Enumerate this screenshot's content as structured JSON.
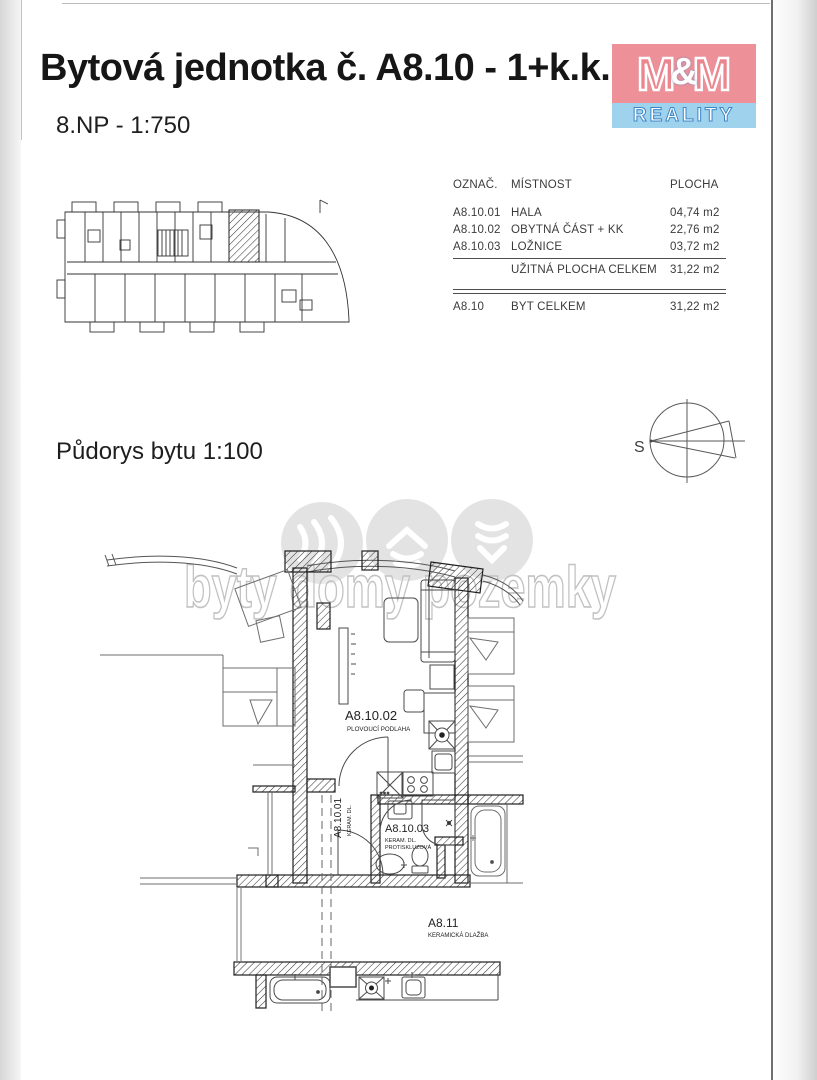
{
  "page": {
    "title": "Bytová jednotka č. A8.10 - 1+k.k.",
    "floor_label": "8.NP - 1:750",
    "plan_label": "Půdorys bytu 1:100"
  },
  "logo": {
    "m_left": "M",
    "ampersand": "&",
    "m_right": "M",
    "reality": "REALITY",
    "pink": "#ee9097",
    "blue": "#9fd2ec"
  },
  "table": {
    "headers": [
      "OZNAČ.",
      "MÍSTNOST",
      "PLOCHA"
    ],
    "rows": [
      {
        "code": "A8.10.01",
        "room": "HALA",
        "area": "04,74 m2"
      },
      {
        "code": "A8.10.02",
        "room": "OBYTNÁ ČÁST + KK",
        "area": "22,76 m2"
      },
      {
        "code": "A8.10.03",
        "room": "LOŽNICE",
        "area": "03,72 m2"
      }
    ],
    "subtotal": {
      "code": "",
      "room": "UŽITNÁ PLOCHA CELKEM",
      "area": "31,22 m2"
    },
    "total": {
      "code": "A8.10",
      "room": "BYT CELKEM",
      "area": "31,22 m2"
    }
  },
  "compass": {
    "north_label": "S"
  },
  "watermark": {
    "text": "byty domy pozemky"
  },
  "plan": {
    "living": {
      "code": "A8.10.02",
      "floor": "PLOVOUCÍ PODLAHA"
    },
    "hall": {
      "code": "A8.10.01",
      "floor": "KERAM. DL."
    },
    "bath": {
      "code": "A8.10.03",
      "floor_line1": "KERAM. DL.",
      "floor_line2": "PROTISKLUZOVÁ"
    },
    "corridor": {
      "code": "A8.11",
      "floor": "KERAMICKÁ DLAŽBA"
    }
  }
}
